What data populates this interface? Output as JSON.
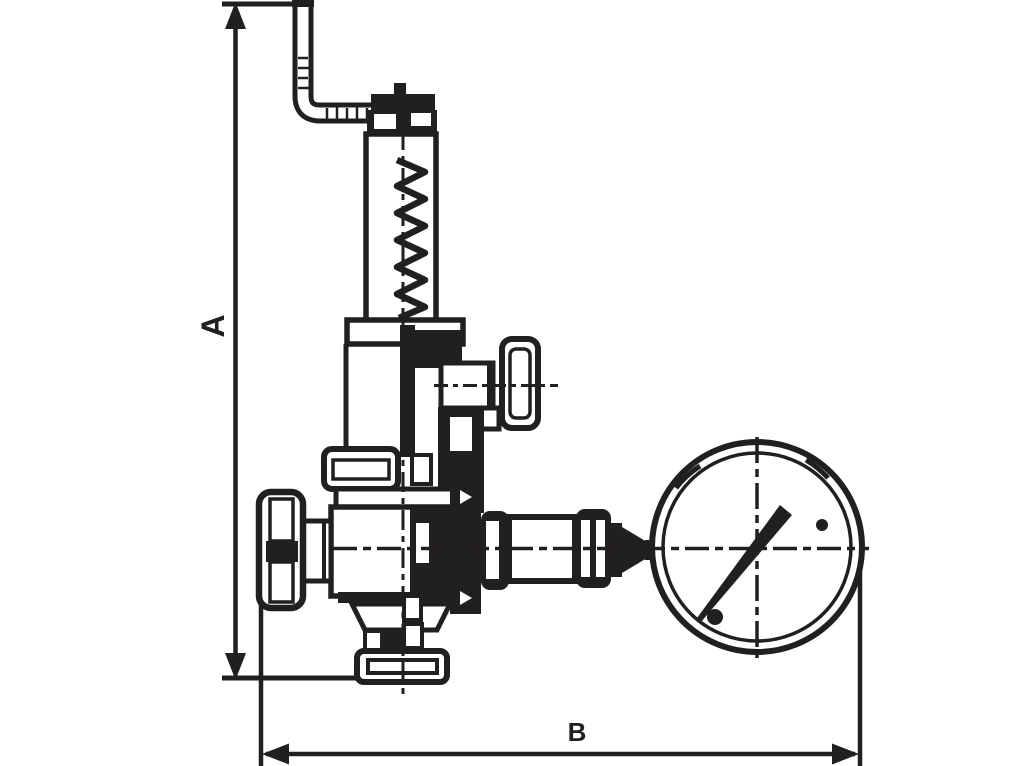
{
  "drawing": {
    "type": "technical-dimension-drawing",
    "subject": "angle safety valve with lever, spring bonnet, two handwheels and pressure gauge",
    "background_color": "#ffffff",
    "line_color": "#221f20",
    "dimension_labels": {
      "height": "A",
      "width": "B"
    }
  }
}
